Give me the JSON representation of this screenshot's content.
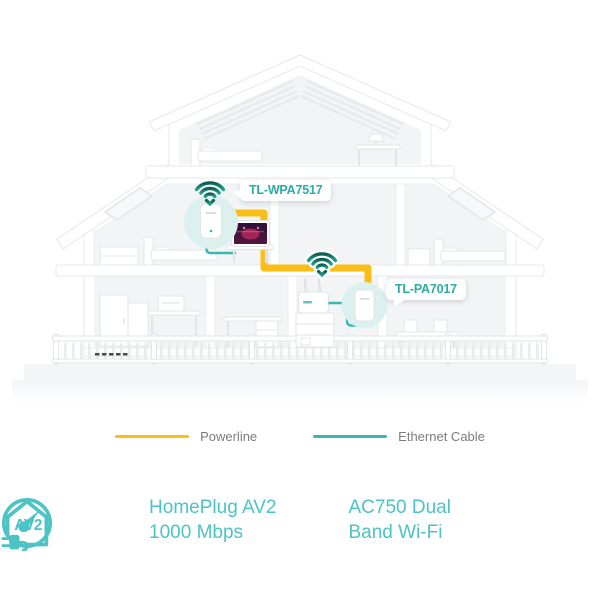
{
  "devices": {
    "extender": {
      "label": "TL-WPA7517"
    },
    "adapter": {
      "label": "TL-PA7017"
    }
  },
  "legend": {
    "powerline": {
      "label": "Powerline"
    },
    "ethernet": {
      "label": "Ethernet Cable"
    }
  },
  "features": {
    "homeplug": {
      "badge": "AV2",
      "line1": "HomePlug AV2",
      "line2": "1000 Mbps"
    },
    "wifi": {
      "line1": "AC750 Dual",
      "line2": "Band Wi-Fi"
    }
  },
  "icons": {
    "wifi": "wifi-signal-icon",
    "homeplug": "av2-house-plug-icon",
    "gauge": "speed-gauge-icon"
  },
  "colors": {
    "powerline_yellow": "#FBBE17",
    "ethernet_teal": "#38B7B3",
    "accent_teal": "#4CC3C5",
    "label_teal": "#2BACA4",
    "legend_text": "#7C7C7C",
    "wifi_dark": "#0F5E54",
    "wifi_light": "#1FA08D",
    "device_circle": "#DCF1EF"
  }
}
